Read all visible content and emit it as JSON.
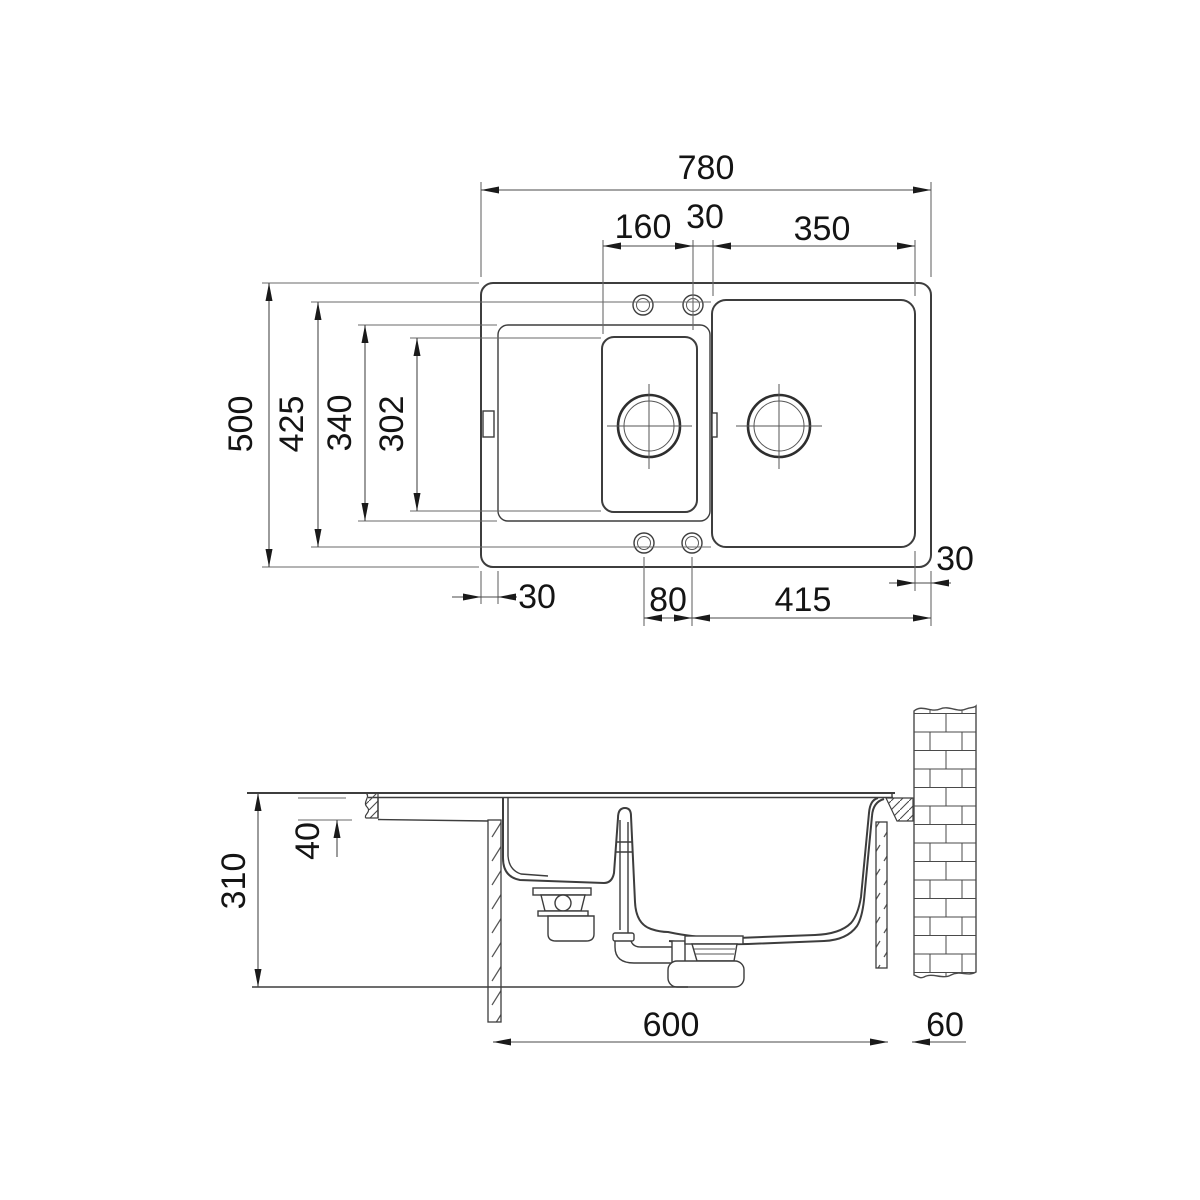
{
  "top_view": {
    "dim_overall_width": "780",
    "dim_tap_ledge_width": "160",
    "dim_tap_gap": "30",
    "dim_main_bowl_width": "350",
    "dim_overall_depth": "500",
    "dim_main_bowl_depth": "425",
    "dim_drainboard_depth": "340",
    "dim_small_bowl_depth": "302",
    "dim_left_margin": "30",
    "dim_hole_spacing": "80",
    "dim_hole_to_edge": "415",
    "dim_right_margin": "30"
  },
  "section_view": {
    "dim_total_depth": "310",
    "dim_rim_drop": "40",
    "dim_cabinet_width": "600",
    "dim_wall_clearance": "60"
  },
  "colors": {
    "background": "#ffffff",
    "line_primary": "#3d3d3d",
    "extension_line": "#6a6a6a",
    "text": "#141414"
  }
}
